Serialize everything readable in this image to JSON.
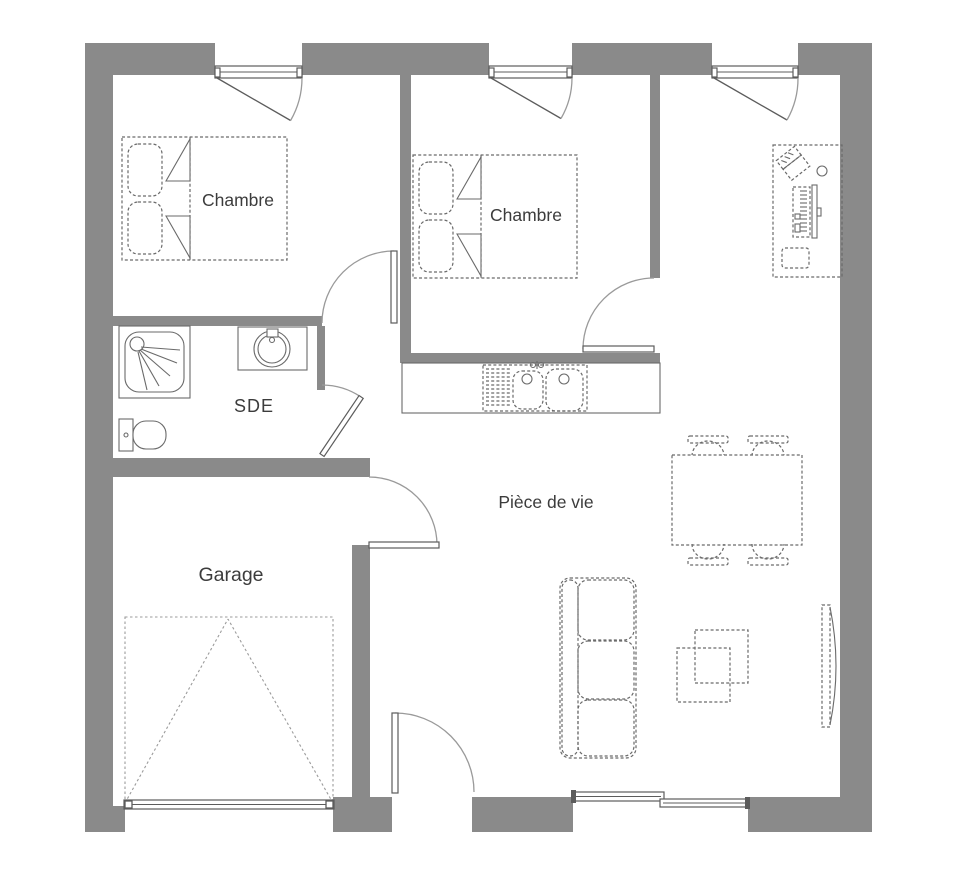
{
  "plan": {
    "type": "floor-plan",
    "rooms": [
      {
        "id": "chambre-1",
        "label": "Chambre"
      },
      {
        "id": "chambre-2",
        "label": "Chambre"
      },
      {
        "id": "sde",
        "label": "SDE"
      },
      {
        "id": "garage",
        "label": "Garage"
      },
      {
        "id": "piece-de-vie",
        "label": "Pièce de vie"
      }
    ],
    "furniture": [
      "double-bed",
      "double-bed",
      "desk-with-computer",
      "shower",
      "washbasin",
      "toilet",
      "kitchen-sink-counter",
      "dining-table-with-four-chairs",
      "sofa",
      "coffee-table",
      "tv",
      "garage-door"
    ],
    "colors": {
      "wall": "#8a8a8a",
      "line": "#5c5c5c",
      "furn": "#6a6a6a",
      "text": "#3c3c3c",
      "arc": "#9a9a9a",
      "bg": "#ffffff"
    }
  }
}
